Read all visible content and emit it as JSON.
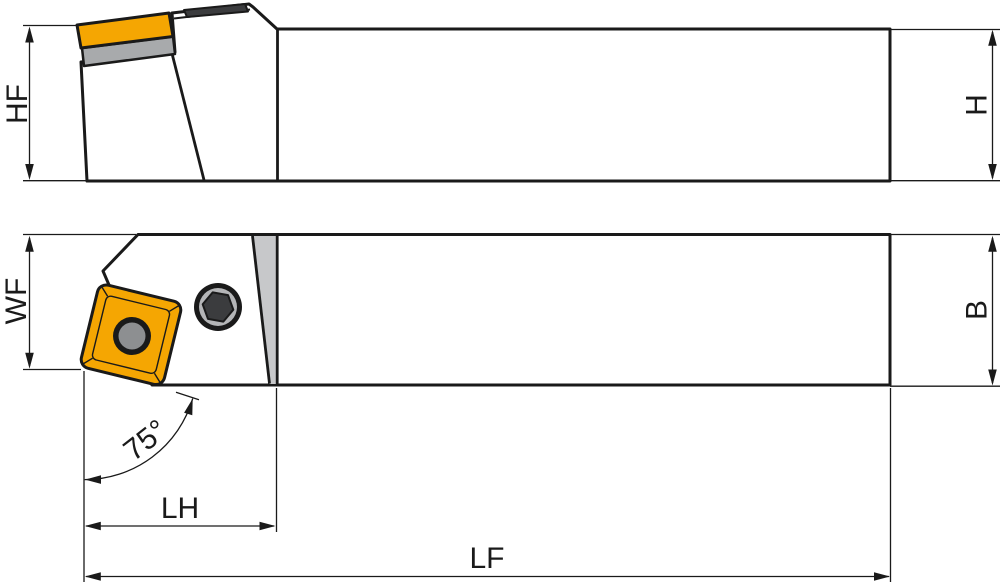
{
  "diagram": {
    "type": "technical-drawing",
    "subject": "lathe external turning tool holder shown in two orthographic views with dimension callouts",
    "labels": {
      "hf": "HF",
      "h": "H",
      "wf": "WF",
      "b": "B",
      "lh": "LH",
      "lf": "LF",
      "angle": "75°"
    },
    "colors": {
      "outline": "#1a1a1a",
      "body": "#d3d4d6",
      "body_shaded": "#c7c8ca",
      "insert": "#f5a602",
      "shim": "#a8aaac",
      "slot": "#3b3c3e",
      "screw_ring": "#b4b5b7",
      "screw_hex": "#3b3c3e",
      "hole": "#8d8f91",
      "background": "#ffffff"
    }
  }
}
